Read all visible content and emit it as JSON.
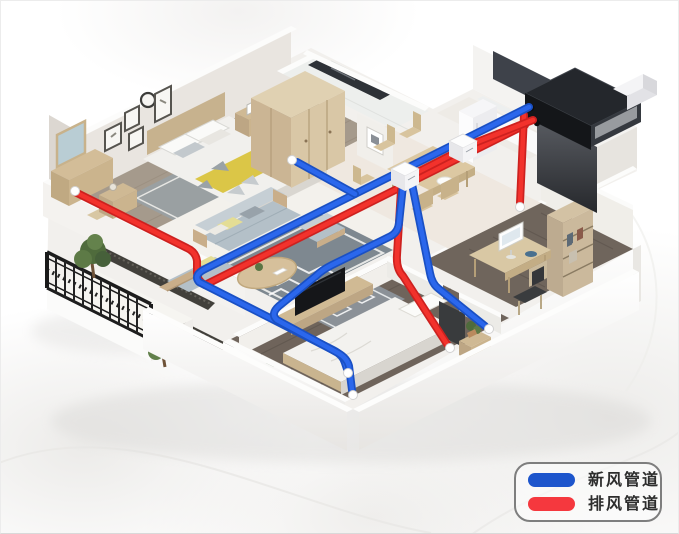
{
  "scene": {
    "description": "isometric apartment cutaway with fresh-air ventilation ducting",
    "background": "#ffffff"
  },
  "legend": {
    "items": [
      {
        "id": "fresh-air-duct",
        "label": "新风管道",
        "color": "#1d55cc"
      },
      {
        "id": "exhaust-air-duct",
        "label": "排风管道",
        "color": "#f5383e"
      }
    ]
  },
  "colors": {
    "pipe-fresh": "#2b67ec",
    "pipe-fresh-dark": "#1a50c4",
    "pipe-exhaust": "#f2322c",
    "pipe-exhaust-dark": "#cd211f",
    "legend-border": "#7e7e7e",
    "unit-body": "#202329",
    "vent-terminal": "#ffffff"
  }
}
